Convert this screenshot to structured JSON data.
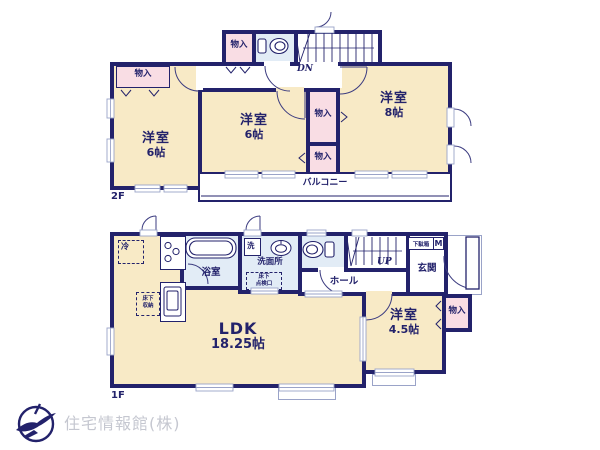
{
  "floor2": {
    "floor_label": "2F",
    "room_west": {
      "name": "洋室",
      "size": "6帖"
    },
    "room_center": {
      "name": "洋室",
      "size": "6帖"
    },
    "room_east": {
      "name": "洋室",
      "size": "8帖"
    },
    "closet_top": "物入",
    "closet_west": "物入",
    "closet_mid_upper": "物入",
    "closet_mid_lower": "物入",
    "stairs_label": "DN",
    "balcony_label": "バルコニー"
  },
  "floor1": {
    "floor_label": "1F",
    "ldk": {
      "name": "LDK",
      "size": "18.25帖"
    },
    "bedroom": {
      "name": "洋室",
      "size": "4.5帖"
    },
    "closet": "物入",
    "bath_label": "浴室",
    "washroom_label": "洗面所",
    "washer_label": "洗",
    "fridge_label": "冷",
    "hall_label": "ホール",
    "entrance_label": "玄関",
    "shoe_cabinet_label": "下駄箱",
    "shoe_cabinet_size": "M",
    "stairs_label": "UP",
    "inspection_hatch": {
      "line1": "床下",
      "line2": "点検口"
    },
    "underfloor_storage": {
      "line1": "床下",
      "line2": "収納"
    }
  },
  "footer": {
    "company": "住宅情報館(株)"
  }
}
